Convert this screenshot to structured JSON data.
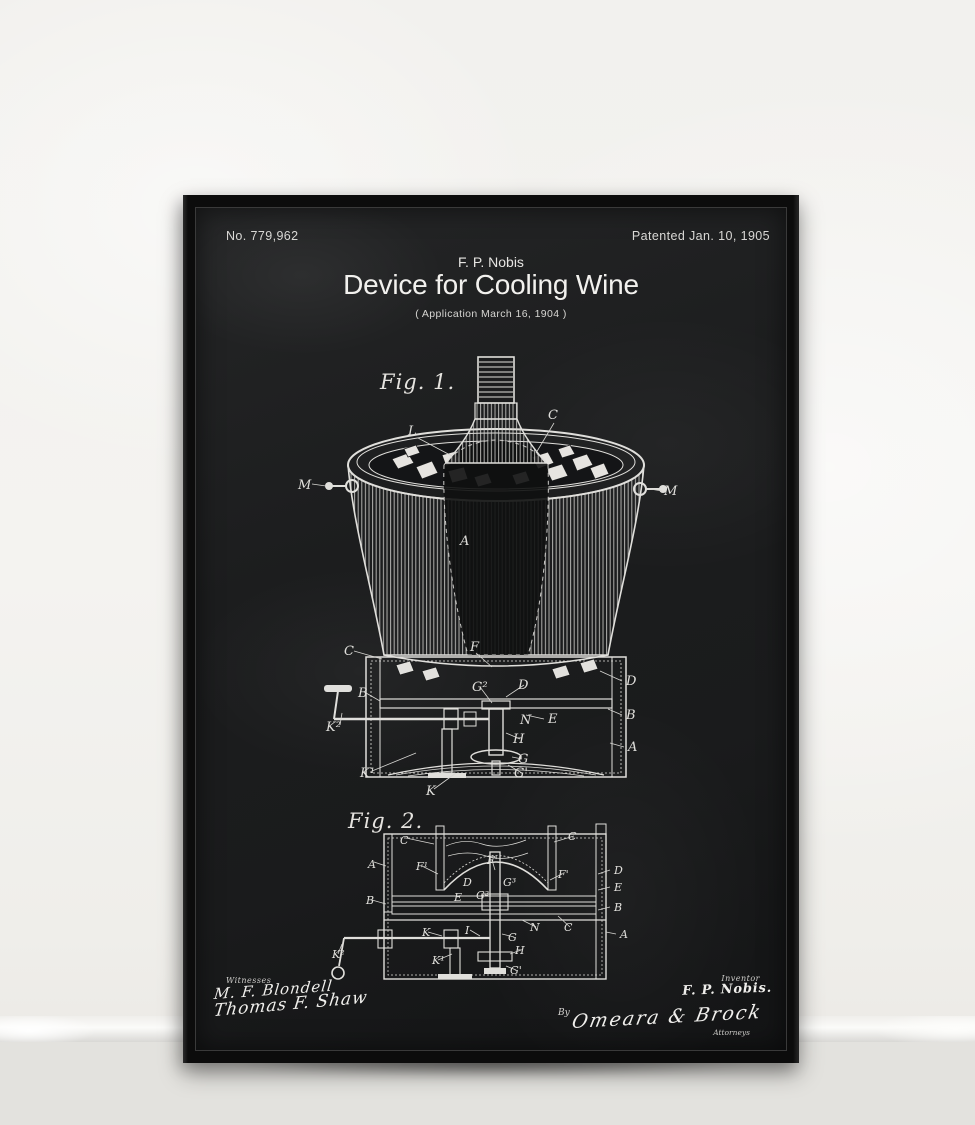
{
  "poster": {
    "header": {
      "patent_number": "No. 779,962",
      "patented_date": "Patented Jan. 10, 1905"
    },
    "title_block": {
      "inventor": "F. P. Nobis",
      "title": "Device for Cooling Wine",
      "application": "( Application  March 16, 1904 )"
    },
    "figure1": {
      "label": "Fig. 1.",
      "part_labels": [
        {
          "t": "L",
          "x": 112,
          "y": 82
        },
        {
          "t": "C",
          "x": 252,
          "y": 66
        },
        {
          "t": "M",
          "x": 2,
          "y": 136
        },
        {
          "t": "M",
          "x": 368,
          "y": 142
        },
        {
          "t": "A",
          "x": 164,
          "y": 192
        },
        {
          "t": "C",
          "x": 48,
          "y": 302
        },
        {
          "t": "F",
          "x": 174,
          "y": 298
        },
        {
          "t": "B",
          "x": 62,
          "y": 344
        },
        {
          "t": "D",
          "x": 222,
          "y": 336
        },
        {
          "t": "G²",
          "x": 176,
          "y": 338
        },
        {
          "t": "D",
          "x": 330,
          "y": 332
        },
        {
          "t": "B",
          "x": 330,
          "y": 366
        },
        {
          "t": "A",
          "x": 332,
          "y": 398
        },
        {
          "t": "E",
          "x": 252,
          "y": 370
        },
        {
          "t": "N",
          "x": 224,
          "y": 371
        },
        {
          "t": "H",
          "x": 217,
          "y": 390
        },
        {
          "t": "G",
          "x": 222,
          "y": 410
        },
        {
          "t": "G'",
          "x": 218,
          "y": 424
        },
        {
          "t": "K²",
          "x": 30,
          "y": 378
        },
        {
          "t": "K¹",
          "x": 64,
          "y": 424
        },
        {
          "t": "K",
          "x": 130,
          "y": 442
        }
      ]
    },
    "figure2": {
      "label": "Fig. 2.",
      "part_labels": [
        {
          "t": "C",
          "x": 74,
          "y": 40
        },
        {
          "t": "C",
          "x": 242,
          "y": 36
        },
        {
          "t": "A",
          "x": 42,
          "y": 64
        },
        {
          "t": "F¹",
          "x": 90,
          "y": 66
        },
        {
          "t": "F'",
          "x": 161,
          "y": 60
        },
        {
          "t": "F'",
          "x": 232,
          "y": 74
        },
        {
          "t": "D",
          "x": 137,
          "y": 82
        },
        {
          "t": "G³",
          "x": 177,
          "y": 82
        },
        {
          "t": "E",
          "x": 128,
          "y": 97
        },
        {
          "t": "G²",
          "x": 150,
          "y": 95
        },
        {
          "t": "D",
          "x": 288,
          "y": 70
        },
        {
          "t": "E",
          "x": 288,
          "y": 87
        },
        {
          "t": "B",
          "x": 40,
          "y": 100
        },
        {
          "t": "B",
          "x": 288,
          "y": 107
        },
        {
          "t": "N",
          "x": 204,
          "y": 127
        },
        {
          "t": "C",
          "x": 238,
          "y": 127
        },
        {
          "t": "K",
          "x": 96,
          "y": 132
        },
        {
          "t": "I",
          "x": 139,
          "y": 130
        },
        {
          "t": "G",
          "x": 182,
          "y": 137
        },
        {
          "t": "H",
          "x": 189,
          "y": 150
        },
        {
          "t": "K¹",
          "x": 106,
          "y": 160
        },
        {
          "t": "K²",
          "x": 6,
          "y": 154
        },
        {
          "t": "G'",
          "x": 184,
          "y": 170
        },
        {
          "t": "A",
          "x": 294,
          "y": 134
        }
      ]
    },
    "footer": {
      "witnesses_label": "Witnesses",
      "witness_signature_1": "M. F. Blondell",
      "witness_signature_2": "Thomas F. Shaw",
      "inventor_label": "Inventor",
      "inventor_signature": "F. P. Nobis.",
      "by_label": "By",
      "attorney_signature": "Omeara & Brock",
      "attorneys_label": "Attorneys"
    },
    "colors": {
      "chalkboard": "#1b1c1d",
      "chalk": "#e9e8e5",
      "frame": "#0c0c0c",
      "wall": "#f2f1ee",
      "floor": "#d8d7d4"
    }
  }
}
